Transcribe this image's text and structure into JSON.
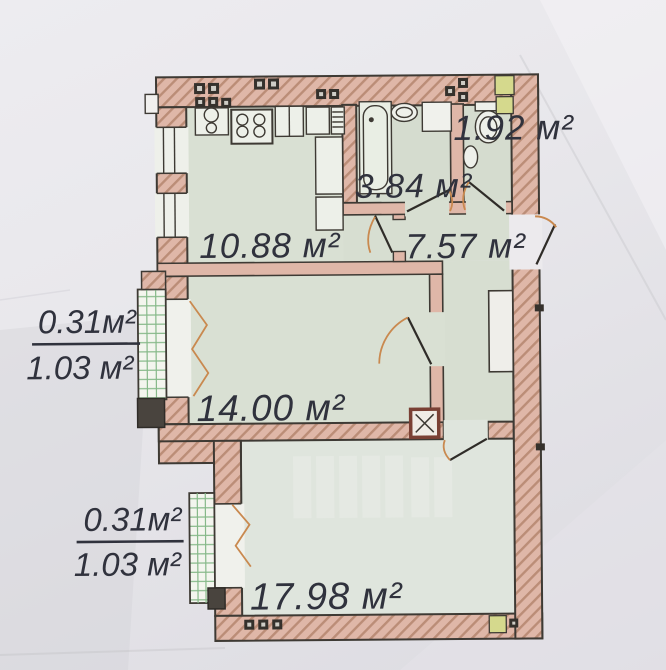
{
  "plan": {
    "description": "apartment floor plan photo",
    "rooms": [
      {
        "id": "kitchen",
        "area": "10.88 м²"
      },
      {
        "id": "bathroom",
        "area": "3.84 м²"
      },
      {
        "id": "toilet",
        "area": "1.92 м²"
      },
      {
        "id": "hallway",
        "area": "7.57 м²"
      },
      {
        "id": "living-room",
        "area": "14.00 м²"
      },
      {
        "id": "bedroom",
        "area": "17.98 м²"
      }
    ],
    "balconies": [
      {
        "id": "balcony-upper",
        "counted_area": "0.31м²",
        "full_area": "1.03 м²"
      },
      {
        "id": "balcony-lower",
        "counted_area": "0.31м²",
        "full_area": "1.03 м²"
      }
    ],
    "colors": {
      "paper": "#e9e8ec",
      "wall_fill": "#dfb7a8",
      "wall_hatch": "#bb8d77",
      "outline": "#3e3a34",
      "floor": "#d9e0d3",
      "floor_light": "#dfe5dd",
      "balcony_grid": "#86b989",
      "vent_square": "#d5d98d",
      "door_arc": "#c9894f",
      "label_text": "#30323d"
    }
  }
}
